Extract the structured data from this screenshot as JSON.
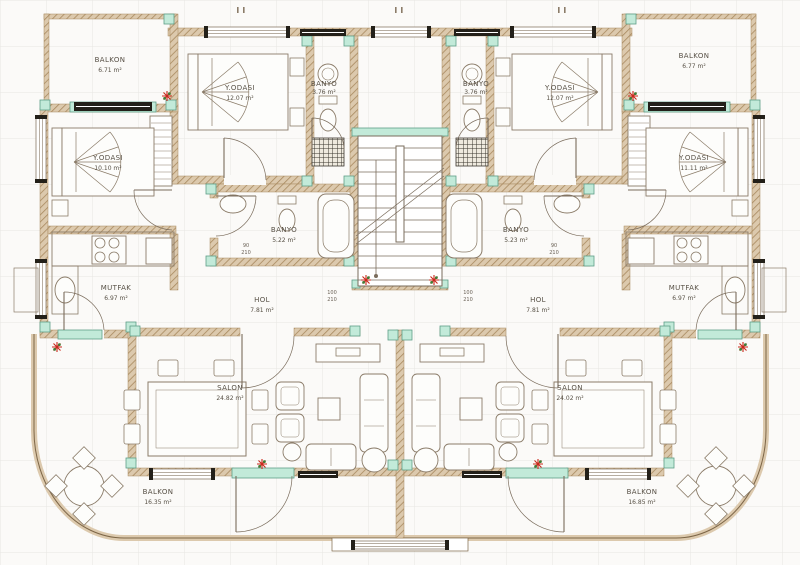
{
  "document_type": "architectural floor plan",
  "language": "Turkish",
  "rooms": {
    "balkon_tl": {
      "label": "BALKON",
      "area": "6.71 m²"
    },
    "yodasi_tl": {
      "label": "Y.ODASI",
      "area": "12.07 m²"
    },
    "yodasi_l": {
      "label": "Y.ODASI",
      "area": "10.10 m²"
    },
    "banyo_tl": {
      "label": "BANYO",
      "area": "3.76 m²"
    },
    "banyo_tr": {
      "label": "BANYO",
      "area": "3.76 m²"
    },
    "yodasi_tr": {
      "label": "Y.ODASI",
      "area": "12.07 m²"
    },
    "yodasi_r": {
      "label": "Y.ODASI",
      "area": "11.11 m²"
    },
    "balkon_tr": {
      "label": "BALKON",
      "area": "6.77 m²"
    },
    "banyo_ml": {
      "label": "BANYO",
      "area": "5.22 m²"
    },
    "banyo_mr": {
      "label": "BANYO",
      "area": "5.23 m²"
    },
    "mutfak_l": {
      "label": "MUTFAK",
      "area": "6.97 m²"
    },
    "mutfak_r": {
      "label": "MUTFAK",
      "area": "6.97 m²"
    },
    "hol_l": {
      "label": "HOL",
      "area": "7.81 m²"
    },
    "hol_r": {
      "label": "HOL",
      "area": "7.81 m²"
    },
    "salon_l": {
      "label": "SALON",
      "area": "24.82 m²"
    },
    "salon_r": {
      "label": "SALON",
      "area": "24.02 m²"
    },
    "balkon_bl": {
      "label": "BALKON",
      "area": "16.35 m²"
    },
    "balkon_br": {
      "label": "BALKON",
      "area": "16.85 m²"
    }
  },
  "door_dimensions": {
    "banyo_door": {
      "width": "90",
      "height": "210"
    },
    "hol_door": {
      "width": "100",
      "height": "210"
    }
  },
  "colors": {
    "paper": "#fbfaf8",
    "grid_line": "#e7e6e2",
    "wall_fill": "#dcc9ad",
    "wall_hatch": "#a8895f",
    "wall_edge": "#7d6647",
    "column_marker": "#c2ead9",
    "column_border": "#5e9e88",
    "frame_black": "#232019",
    "furniture_line": "#8b7c69",
    "door_line": "#7a6c5c",
    "label_text": "#575045",
    "plant_red": "#c9291c",
    "plant_green": "#3f7d36"
  }
}
